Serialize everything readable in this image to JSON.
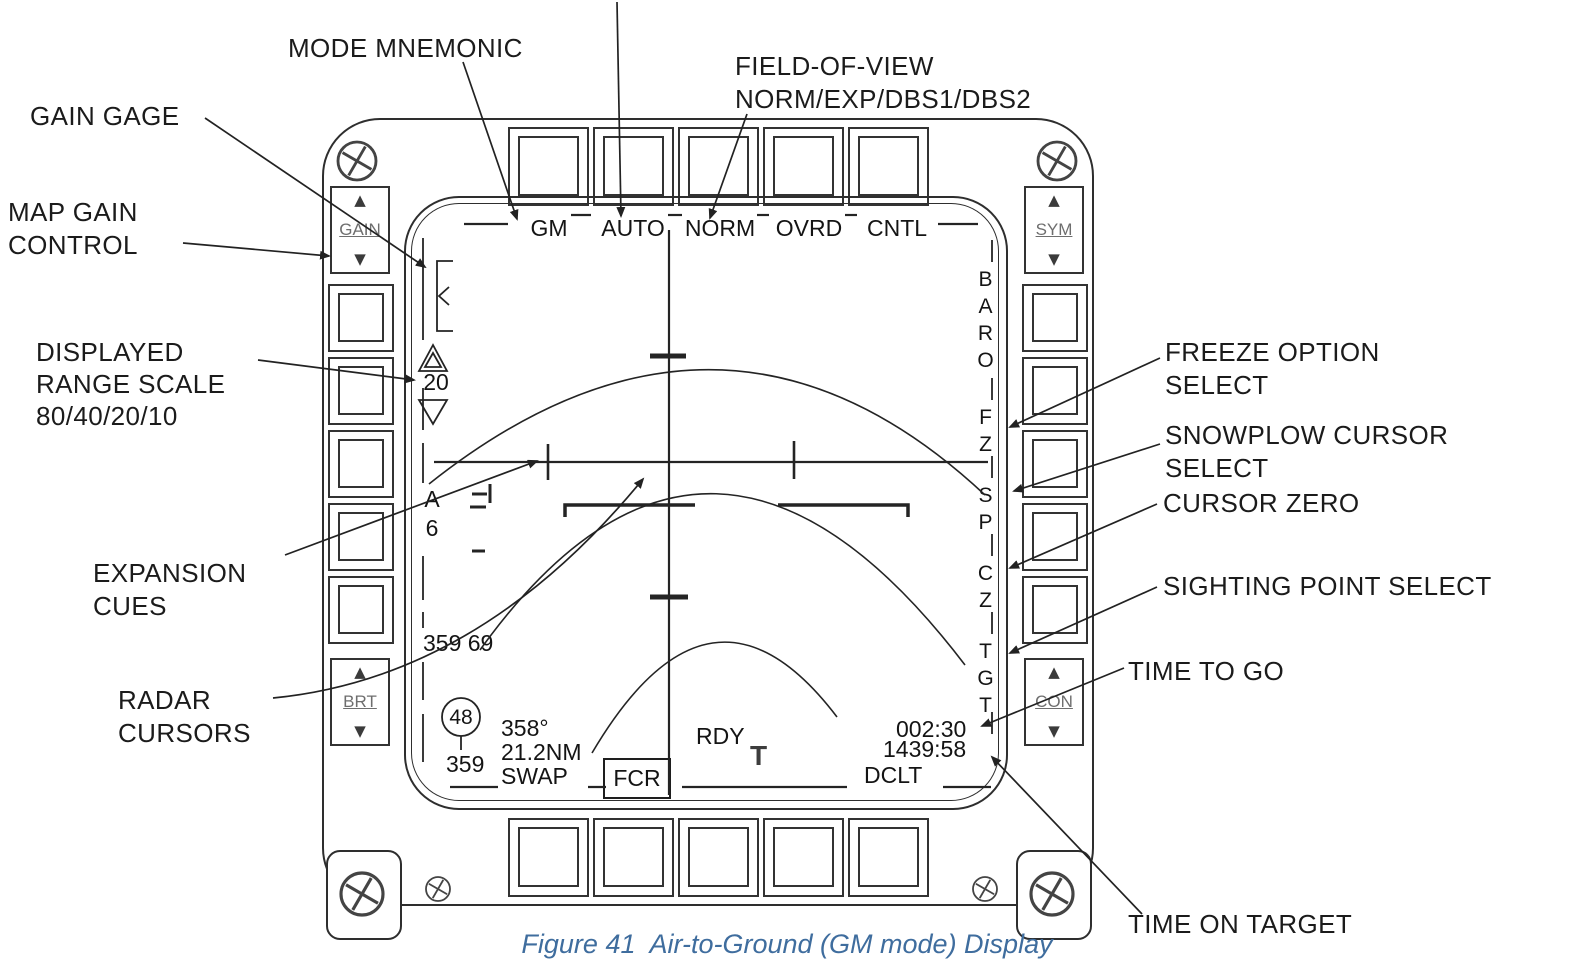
{
  "caption": "Figure 41  Air-to-Ground (GM mode) Display",
  "callouts": {
    "mode_mnemonic": "MODE MNEMONIC",
    "fov_line1": "FIELD-OF-VIEW",
    "fov_line2": "NORM/EXP/DBS1/DBS2",
    "gain_gage": "GAIN GAGE",
    "map_gain_line1": "MAP GAIN",
    "map_gain_line2": "CONTROL",
    "range_line1": "DISPLAYED",
    "range_line2": "RANGE SCALE",
    "range_line3": "80/40/20/10",
    "expansion_line1": "EXPANSION",
    "expansion_line2": "CUES",
    "radar_line1": "RADAR",
    "radar_line2": "CURSORS",
    "freeze_line1": "FREEZE OPTION",
    "freeze_line2": "SELECT",
    "snowplow_line1": "SNOWPLOW CURSOR",
    "snowplow_line2": "SELECT",
    "cursor_zero": "CURSOR ZERO",
    "sighting_point": "SIGHTING POINT SELECT",
    "time_to_go": "TIME TO GO",
    "time_on_target": "TIME ON TARGET"
  },
  "bezel": {
    "gain": "GAIN",
    "sym": "SYM",
    "brt": "BRT",
    "con": "CON",
    "up_arrow": "▲",
    "down_arrow": "▼"
  },
  "display": {
    "mode": "GM",
    "submode": "AUTO",
    "fov": "NORM",
    "ovrd": "OVRD",
    "cntl": "CNTL",
    "range_scale": "20",
    "steerpoint_letter": "A",
    "steerpoint_number": "6",
    "cursor_readout": "359 69",
    "gain_value": "48",
    "gain_sub": "359",
    "bearing": "358°",
    "range_nm": "21.2NM",
    "swap": "SWAP",
    "fcr": "FCR",
    "rdy": "RDY",
    "tgt_symbol": "T",
    "dclt": "DCLT",
    "time_to_go": "002:30",
    "time_on_target": "1439:58",
    "baro": "BARO",
    "fz": "FZ",
    "sp": "SP",
    "cz": "CZ",
    "tgt": "TGT"
  }
}
